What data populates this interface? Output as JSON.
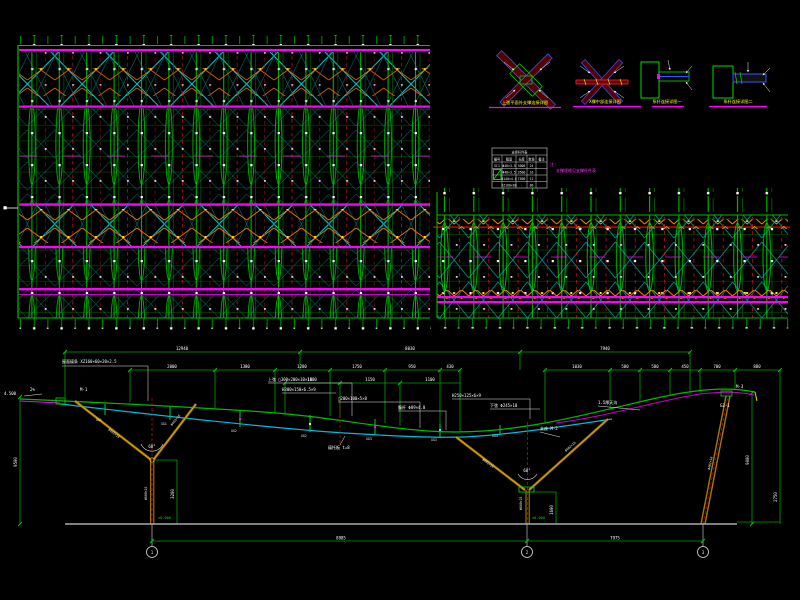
{
  "colors": {
    "background": "#000000",
    "green": "#00b400",
    "cyan": "#00cccc",
    "magenta": "#ff00ff",
    "red": "#ff0000",
    "orange": "#ff7700",
    "yellow": "#ffff00",
    "white": "#ffffff",
    "olive": "#aa7700",
    "ground_gray": "#aaaaaa"
  },
  "details": {
    "items": [
      {
        "label": "上弦平面外支撑连接详图"
      },
      {
        "label": "X撑中部连接详图"
      },
      {
        "label": "系杆连接详图一"
      },
      {
        "label": "系杆连接详图二"
      }
    ]
  },
  "table": {
    "title": "支撑杆件表",
    "headers": [
      "编号",
      "截面",
      "长度",
      "数量",
      "备注"
    ],
    "rows": [
      [
        "SC1",
        "Φ48×3.5",
        "3000",
        "24",
        ""
      ],
      [
        "SC2",
        "Φ48×3.5",
        "3500",
        "16",
        ""
      ],
      [
        "XG1",
        "Φ140×4.0",
        "7500",
        "12",
        ""
      ],
      [
        "LT1",
        "XZ160×60",
        "-",
        "86",
        ""
      ]
    ]
  },
  "note": {
    "line1": "注:",
    "line2": "支撑规格见支撑杆件表"
  },
  "elevation": {
    "dims_row1": [
      "12940",
      "8030",
      "7940"
    ],
    "dims_row2_left": [
      "2000",
      "1380",
      "1280",
      "1750",
      "950",
      "430"
    ],
    "dims_row2_right": [
      "1030",
      "580",
      "580",
      "450",
      "700",
      "880"
    ],
    "dims_row3": [
      "1100",
      "1150",
      "1100"
    ],
    "left_dim": "9500",
    "left_level": "4.500",
    "right_dim": "9000",
    "right_dim2": "2750",
    "v1_dim": "3200",
    "v2_dim": "1600",
    "bottom_dims": [
      "8985",
      "7975"
    ],
    "bubbles": [
      "1",
      "2",
      "3"
    ],
    "levels": [
      "±0.000",
      "±0.000"
    ],
    "slope": "2%",
    "angle1": "60°",
    "angle2": "60°",
    "annotations": [
      "屋面檩条 XZ160×60×20×2.5",
      "M-1",
      "上弦 □300×200×10×10",
      "H300×150×6.5×9",
      "□200×100×5×8",
      "腹杆 Φ89×4.0",
      "H250×125×6×9",
      "下弦 Φ245×10",
      "支座 M-2",
      "檩托板 t=8",
      "1.5厚天沟",
      "GZ-1",
      "M-3"
    ],
    "member_tags": [
      "XG1",
      "XG1",
      "XG2",
      "XG2",
      "XG3",
      "XG3",
      "XG4"
    ],
    "leg_tags": [
      "Φ402×16",
      "Φ402×16",
      "Φ402×16",
      "Φ402×16",
      "Φ402×16"
    ],
    "trunk_tags": [
      "Φ600×25",
      "Φ600×25"
    ]
  }
}
